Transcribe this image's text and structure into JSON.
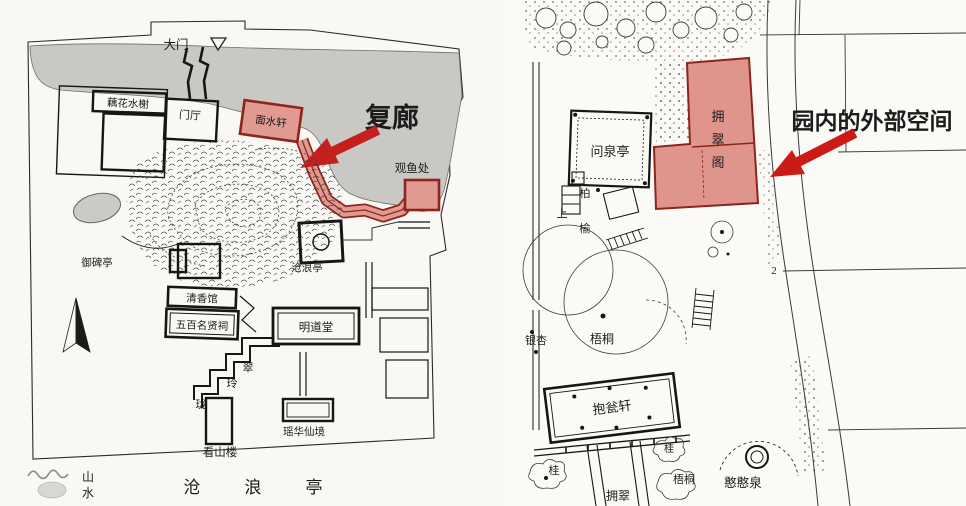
{
  "colors": {
    "annotation_red": "#c4201d",
    "highlight_fill": "#e09a92",
    "highlight_border": "#8f241c",
    "water_grey": "#c9c8c4",
    "line_black": "#222222"
  },
  "left_plan": {
    "labels": {
      "gate": "大门",
      "lotus_pavilion": "藕花水榭",
      "entrance_hall": "门厅",
      "mianshui_xuan": "面水轩",
      "fish_viewing": "观鱼处",
      "imperial_stele_pavilion": "御碑亭",
      "canglang_pavilion": "沧浪亭",
      "qingxiang_hall": "清香馆",
      "five_hundred_sages_shrine": "五百名贤祠",
      "mingdao_hall": "明道堂",
      "cuilinglong": [
        "翠",
        "玲",
        "珑"
      ],
      "kanshan_tower": "看山楼",
      "yaohua_realm": "瑶华仙境"
    },
    "annotation": "复廊",
    "watermark_chars": [
      "山",
      "水"
    ],
    "bottom_title": [
      "沧",
      "浪",
      "亭"
    ]
  },
  "right_plan": {
    "annotation": "园内的外部空间",
    "highlight_chars": [
      "拥",
      "翠",
      "阁"
    ],
    "labels": {
      "wenquan_pavilion": "问泉亭",
      "cypress": "柏",
      "elm": "榆",
      "up": "上",
      "ginkgo": "银杏",
      "wutong_mid": "梧桐",
      "baoweng_xuan": "抱瓮轩",
      "osmanthus_left": "桂",
      "osmanthus_mid": "桂",
      "wutong_bottom": "梧桐",
      "yongcui_corridor": "拥翠",
      "hanhan_spring": "憨憨泉",
      "grid_number": "2"
    }
  }
}
